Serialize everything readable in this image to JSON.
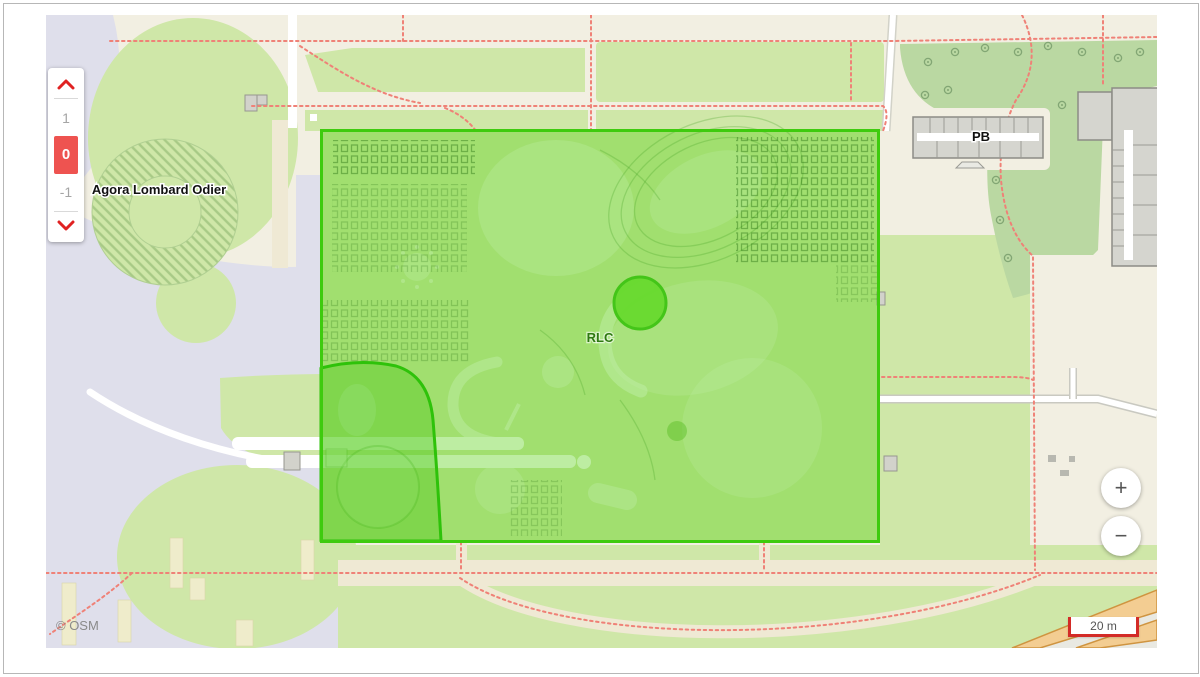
{
  "map": {
    "attribution_label": "© OSM",
    "scale_bar_label": "20 m",
    "place_labels": {
      "agora": "Agora Lombard Odier",
      "building_pb": "PB",
      "building_rlc": "RLC"
    },
    "selection": {
      "fill_color": "#61d422",
      "border_color": "#3ecb0e",
      "marker_color": "#68da2e"
    }
  },
  "floor_selector": {
    "floors": [
      "1",
      "0",
      "-1"
    ],
    "active_floor": "0",
    "active_color": "#ee5350"
  },
  "zoom_controls": {
    "zoom_in_label": "+",
    "zoom_out_label": "−"
  }
}
